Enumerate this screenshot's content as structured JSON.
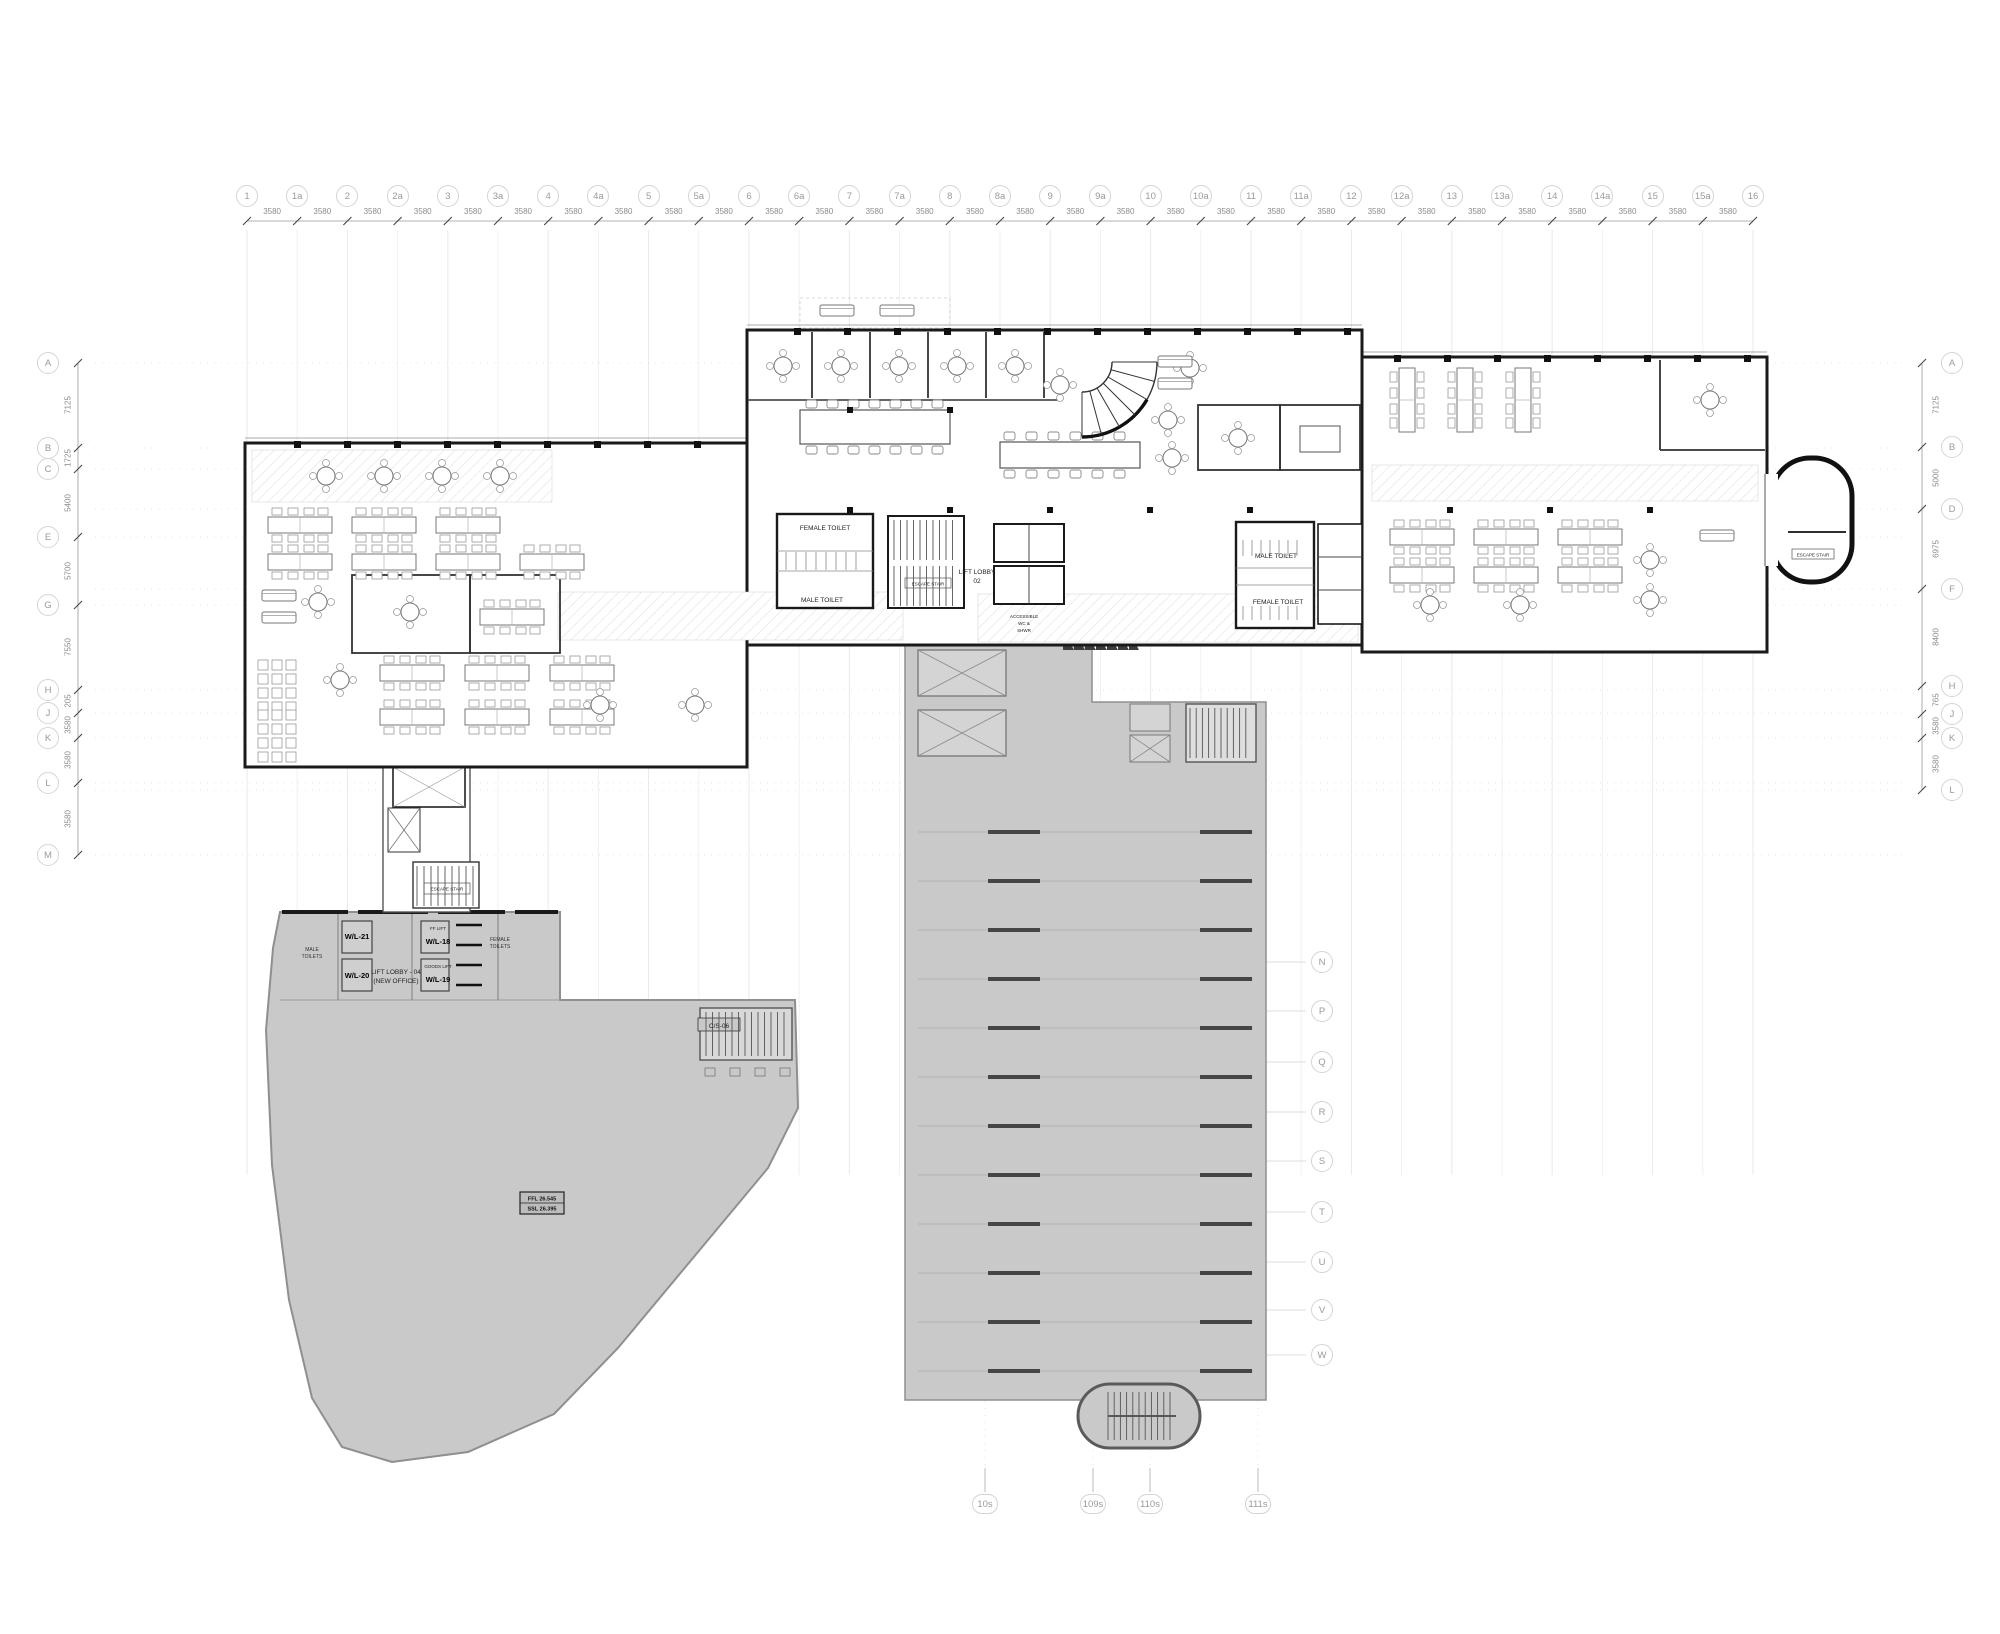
{
  "grid": {
    "top": {
      "labels": [
        "1",
        "1a",
        "2",
        "2a",
        "3",
        "3a",
        "4",
        "4a",
        "5",
        "5a",
        "6",
        "6a",
        "7",
        "7a",
        "8",
        "8a",
        "9",
        "9a",
        "10",
        "10a",
        "11",
        "11a",
        "12",
        "12a",
        "13",
        "13a",
        "14",
        "14a",
        "15",
        "15a",
        "16"
      ],
      "spacing_dim": "3580"
    },
    "left": {
      "labels": [
        "A",
        "B",
        "C",
        "E",
        "G",
        "H",
        "J",
        "K",
        "L",
        "M"
      ],
      "dims": [
        "7125",
        "1725",
        "5400",
        "5700",
        "7550",
        "205",
        "3580",
        "3580",
        "3580"
      ]
    },
    "right": {
      "labels": [
        "A",
        "B",
        "D",
        "F",
        "H",
        "J",
        "K",
        "L"
      ],
      "dims": [
        "7125",
        "5000",
        "6975",
        "8400",
        "765",
        "3580",
        "3580"
      ]
    },
    "mid_right": {
      "labels": [
        "N",
        "P",
        "Q",
        "R",
        "S",
        "T",
        "U",
        "V",
        "W"
      ]
    },
    "bottom": {
      "labels": [
        "10s",
        "109s",
        "110s",
        "111s"
      ]
    }
  },
  "upper_core": {
    "female_toilet": "FEMALE TOILET",
    "male_toilet": "MALE TOILET",
    "lift_lobby_line1": "LIFT LOBBY",
    "lift_lobby_line2": "02",
    "accessible_line1": "ACCESSIBLE",
    "accessible_line2": "WC &",
    "accessible_line3": "SHWR",
    "male_toilet_right": "MALE TOILET",
    "female_toilet_right": "FEMALE TOILET",
    "escape_stair": "ESCAPE STAIR"
  },
  "lower_left_building": {
    "wl21": "W/L-21",
    "wl20": "W/L-20",
    "wl18": "W/L-18",
    "wl19": "W/L-19",
    "ff_lift": "FF LIFT",
    "goods_lift": "GOODS LIFT",
    "lift_lobby_line1": "LIFT LOBBY - 04",
    "lift_lobby_line2": "(NEW OFFICE)",
    "male_toilets_line1": "MALE",
    "male_toilets_line2": "TOILETS",
    "female_toilets_line1": "FEMALE",
    "female_toilets_line2": "TOILETS",
    "stair_code": "C/S-06",
    "level_ffl": "FFL 26.545",
    "level_ssl": "SSL 26.395"
  }
}
